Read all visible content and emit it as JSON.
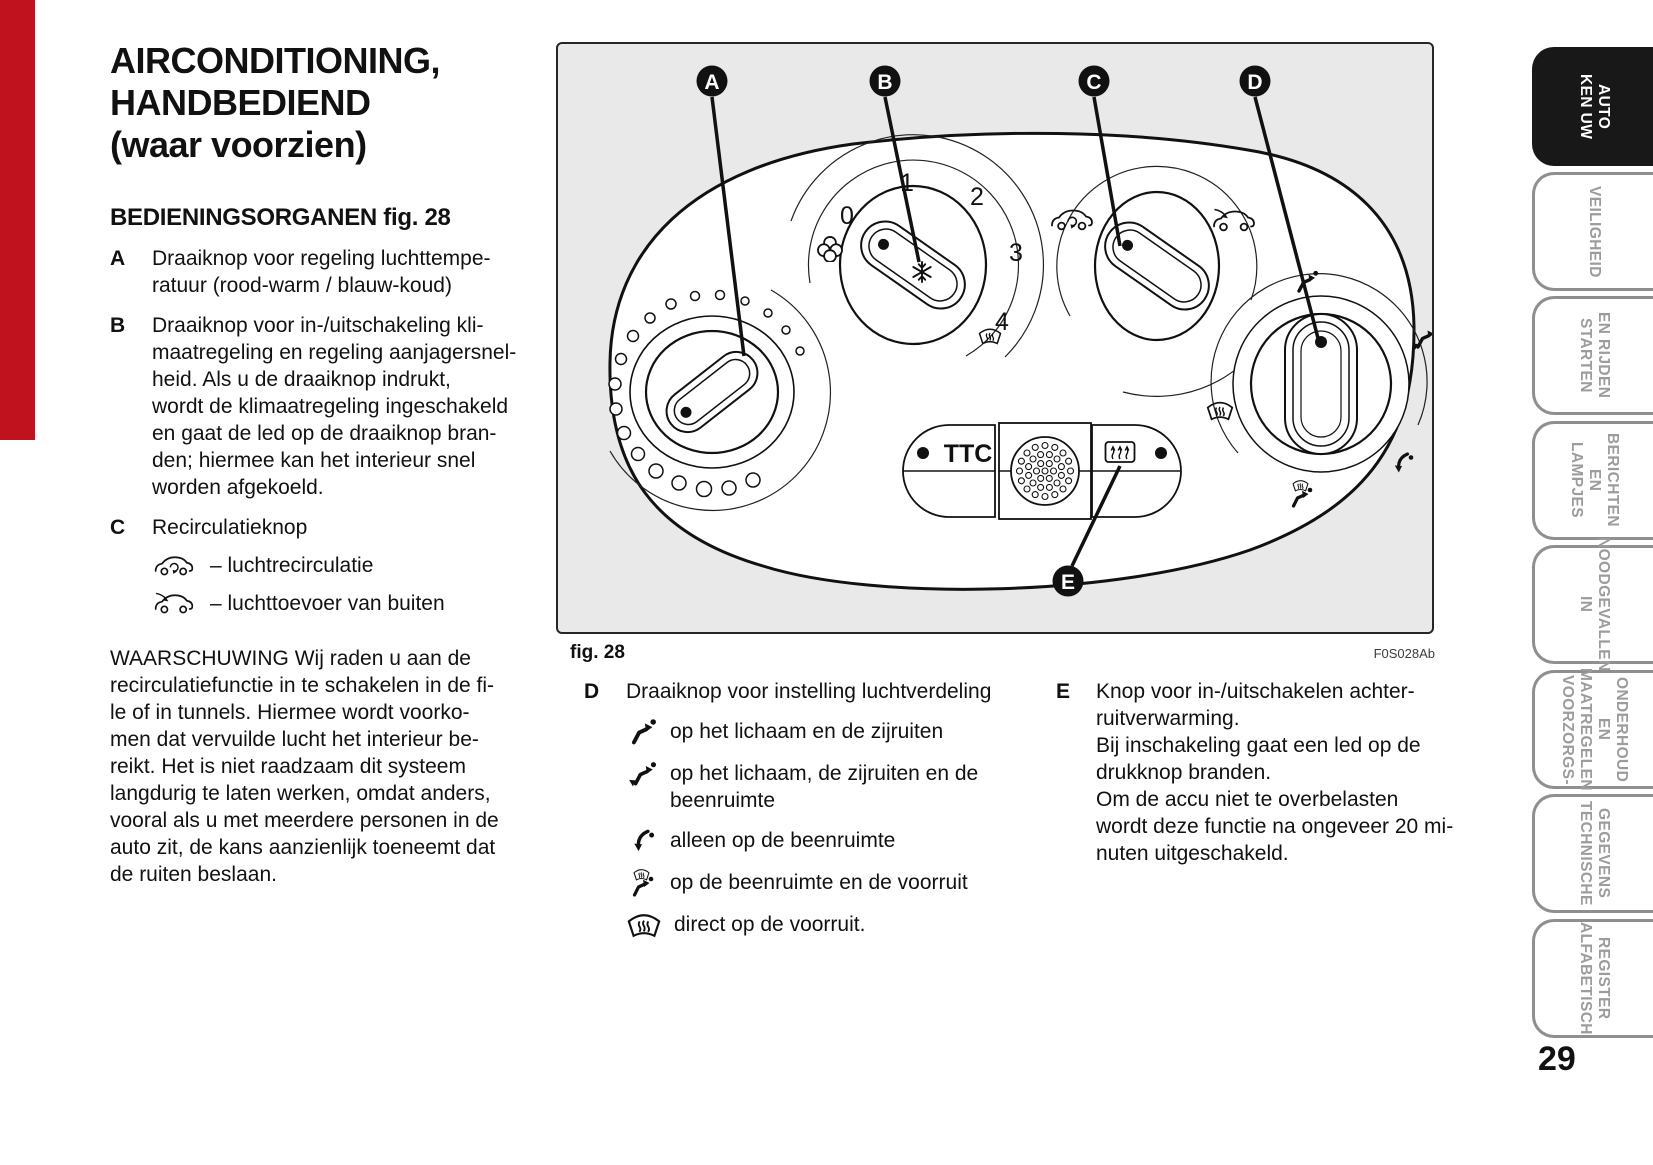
{
  "page": {
    "number": "29"
  },
  "article": {
    "title": "AIRCONDITIONING,\nHANDBEDIEND\n(waar voorzien)",
    "section_heading": "BEDIENINGSORGANEN fig. 28",
    "controls": [
      {
        "label": "A",
        "text": "Draaiknop voor regeling luchttempe-\nratuur (rood-warm / blauw-koud)"
      },
      {
        "label": "B",
        "text": "Draaiknop voor in-/uitschakeling kli-\nmaatregeling en regeling aanjagersnel-\nheid. Als u de draaiknop indrukt,\nwordt de klimaatregeling ingeschakeld\nen gaat de led op de draaiknop bran-\nden; hiermee kan het interieur snel\nworden afgekoeld."
      },
      {
        "label": "C",
        "text": "Recirculatieknop"
      }
    ],
    "recirculation_modes": [
      {
        "icon": "car-recirculation-icon",
        "text": "– luchtrecirculatie"
      },
      {
        "icon": "car-outside-air-icon",
        "text": "– luchttoevoer van buiten"
      }
    ],
    "warning": "WAARSCHUWING Wij raden u aan de\nrecirculatiefunctie in te schakelen in de fi-\nle of in tunnels. Hiermee wordt voorko-\nmen dat vervuilde lucht het interieur be-\nreikt. Het is niet raadzaam dit systeem\nlangdurig te laten werken, omdat anders,\nvooral als u met meerdere personen in de\nauto zit, de kans aanzienlijk toeneemt dat\nde ruiten beslaan."
  },
  "figure": {
    "caption": "fig. 28",
    "code": "F0S028Ab",
    "labels": [
      "A",
      "B",
      "C",
      "D",
      "E"
    ],
    "fan_positions": [
      "0",
      "1",
      "2",
      "3",
      "4"
    ],
    "ttc_label": "TTC"
  },
  "distribution": {
    "label": "D",
    "heading": "Draaiknop voor instelling luchtverdeling",
    "modes": [
      {
        "icon": "airflow-body-icon",
        "text": "op het lichaam en de zijruiten"
      },
      {
        "icon": "airflow-body-feet-icon",
        "text": "op het lichaam, de zijruiten en de\nbeenruimte"
      },
      {
        "icon": "airflow-feet-icon",
        "text": "alleen op de beenruimte"
      },
      {
        "icon": "airflow-feet-windscreen-icon",
        "text": "op de beenruimte en de voorruit"
      },
      {
        "icon": "windscreen-icon",
        "text": "direct op de voorruit."
      }
    ]
  },
  "rear_window": {
    "label": "E",
    "text": "Knop voor in-/uitschakelen achter-\nruitverwarming.\nBij inschakeling gaat een led op de\ndrukknop branden.\nOm de accu niet te overbelasten\nwordt deze functie na ongeveer 20 mi-\nnuten uitgeschakeld."
  },
  "sidebar": {
    "tabs": [
      {
        "label": "KEN UW\nAUTO",
        "active": true
      },
      {
        "label": "VEILIGHEID",
        "active": false
      },
      {
        "label": "STARTEN\nEN RIJDEN",
        "active": false
      },
      {
        "label": "LAMPJES\nEN BERICHTEN",
        "active": false
      },
      {
        "label": "IN\nNOODGEVALLEN",
        "active": false
      },
      {
        "label": "VOORZORGS-\nMAATREGELEN\nEN ONDERHOUD",
        "active": false
      },
      {
        "label": "TECHNISCHE\nGEGEVENS",
        "active": false
      },
      {
        "label": "ALFABETISCH\nREGISTER",
        "active": false
      }
    ]
  },
  "colors": {
    "edge_bar": "#c0111f",
    "active_tab": "#181818",
    "figure_bg": "#e9e9e9"
  }
}
